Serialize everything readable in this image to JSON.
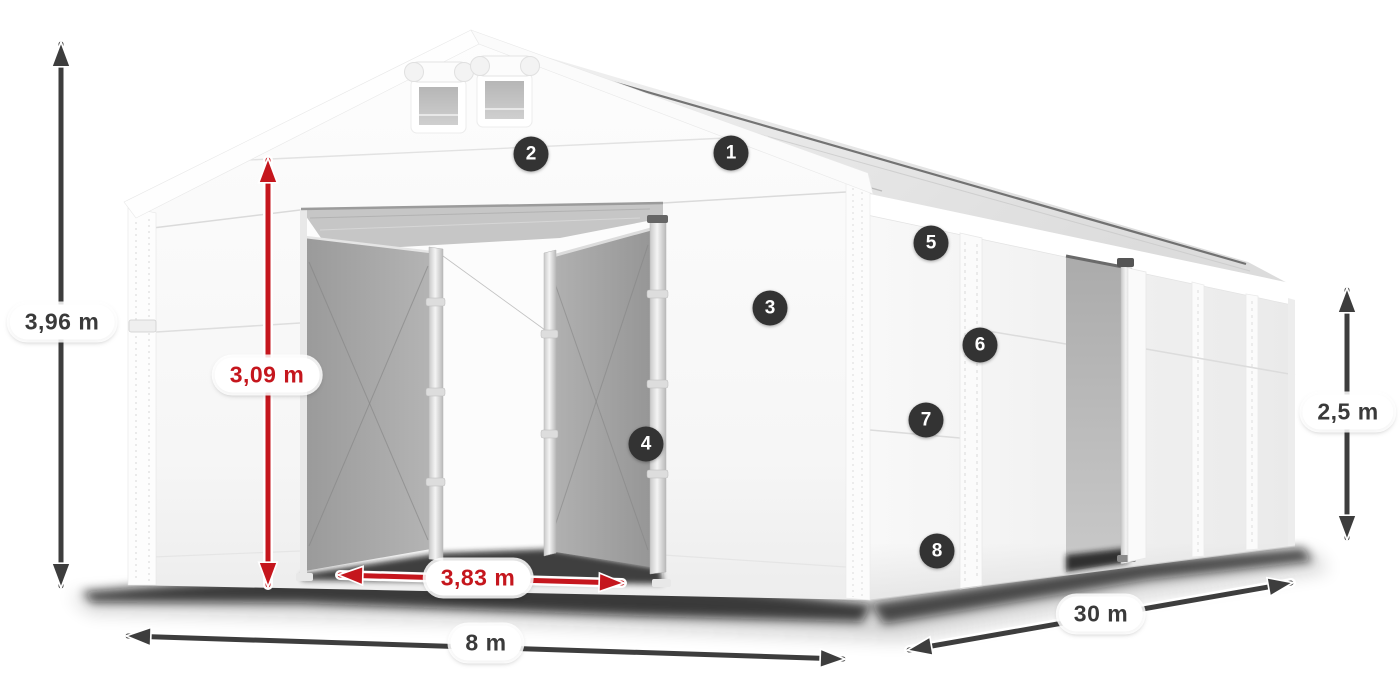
{
  "diagram": {
    "dims": {
      "total_height": "3,96 m",
      "door_height": "3,09 m",
      "door_width": "3,83 m",
      "front_width": "8 m",
      "length": "30 m",
      "side_height": "2,5 m"
    },
    "markers": [
      "1",
      "2",
      "3",
      "4",
      "5",
      "6",
      "7",
      "8"
    ],
    "colors": {
      "dimension_gray": "#3d3d3d",
      "dimension_red": "#c5161d",
      "marker_background": "#333333",
      "tent_interior_gray": "#a0a0a0"
    }
  }
}
